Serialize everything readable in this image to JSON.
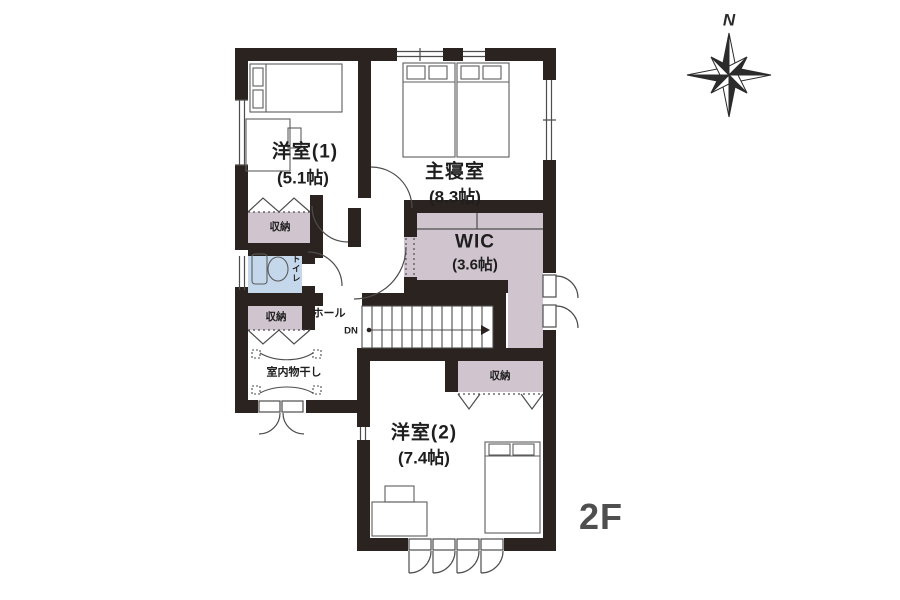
{
  "floor_label": "2F",
  "compass": {
    "north": "N"
  },
  "colors": {
    "wall": "#2a2320",
    "closet_fill": "#d0c4ce",
    "toilet_fill": "#c4d7eb",
    "line": "#4d4d4d",
    "label": "#1e1e1e",
    "floor_label": "#4f4f4f"
  },
  "rooms": {
    "yoshitsu1": {
      "name": "洋室(1)",
      "size": "(5.1帖)"
    },
    "master": {
      "name": "主寝室",
      "size": "(8.3帖)"
    },
    "wic": {
      "name": "WIC",
      "size": "(3.6帖)"
    },
    "yoshitsu2": {
      "name": "洋室(2)",
      "size": "(7.4帖)"
    },
    "hall": {
      "name": "ホール"
    },
    "toilet": {
      "name": "トイレ"
    },
    "drying": {
      "name": "室内物干し"
    }
  },
  "storage": {
    "s1": {
      "name": "収納"
    },
    "s2": {
      "name": "収納"
    },
    "s3": {
      "name": "収納"
    }
  },
  "stairs": {
    "direction": "DN"
  }
}
